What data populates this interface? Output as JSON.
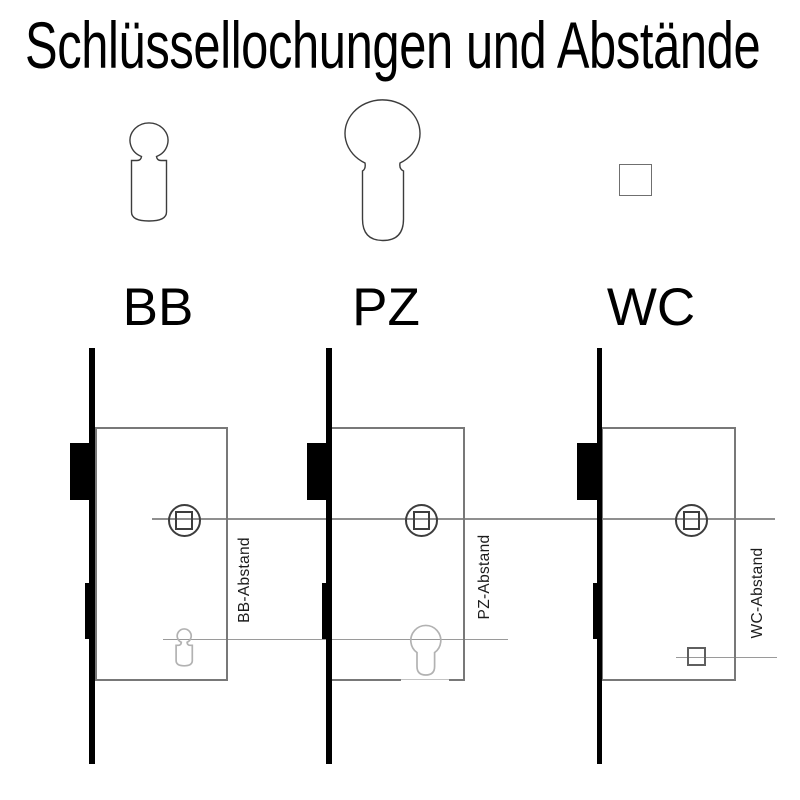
{
  "title": "Schlüssellochungen und Abstände",
  "key_types": [
    {
      "label": "BB",
      "shape": "bb-buntbart-keyhole"
    },
    {
      "label": "PZ",
      "shape": "pz-profile-cylinder"
    },
    {
      "label": "WC",
      "shape": "wc-square-spindle"
    }
  ],
  "locks": [
    {
      "type": "BB",
      "dimension_label": "BB-Abstand"
    },
    {
      "type": "PZ",
      "dimension_label": "PZ-Abstand"
    },
    {
      "type": "WC",
      "dimension_label": "WC-Abstand"
    }
  ],
  "colors": {
    "outline": "#000000",
    "lock_body_stroke": "#787878",
    "reference_line": "#8f8f8f",
    "keyhole_cutout_stroke": "#b2b2b2",
    "spindle_stroke": "#3d3d3d"
  }
}
